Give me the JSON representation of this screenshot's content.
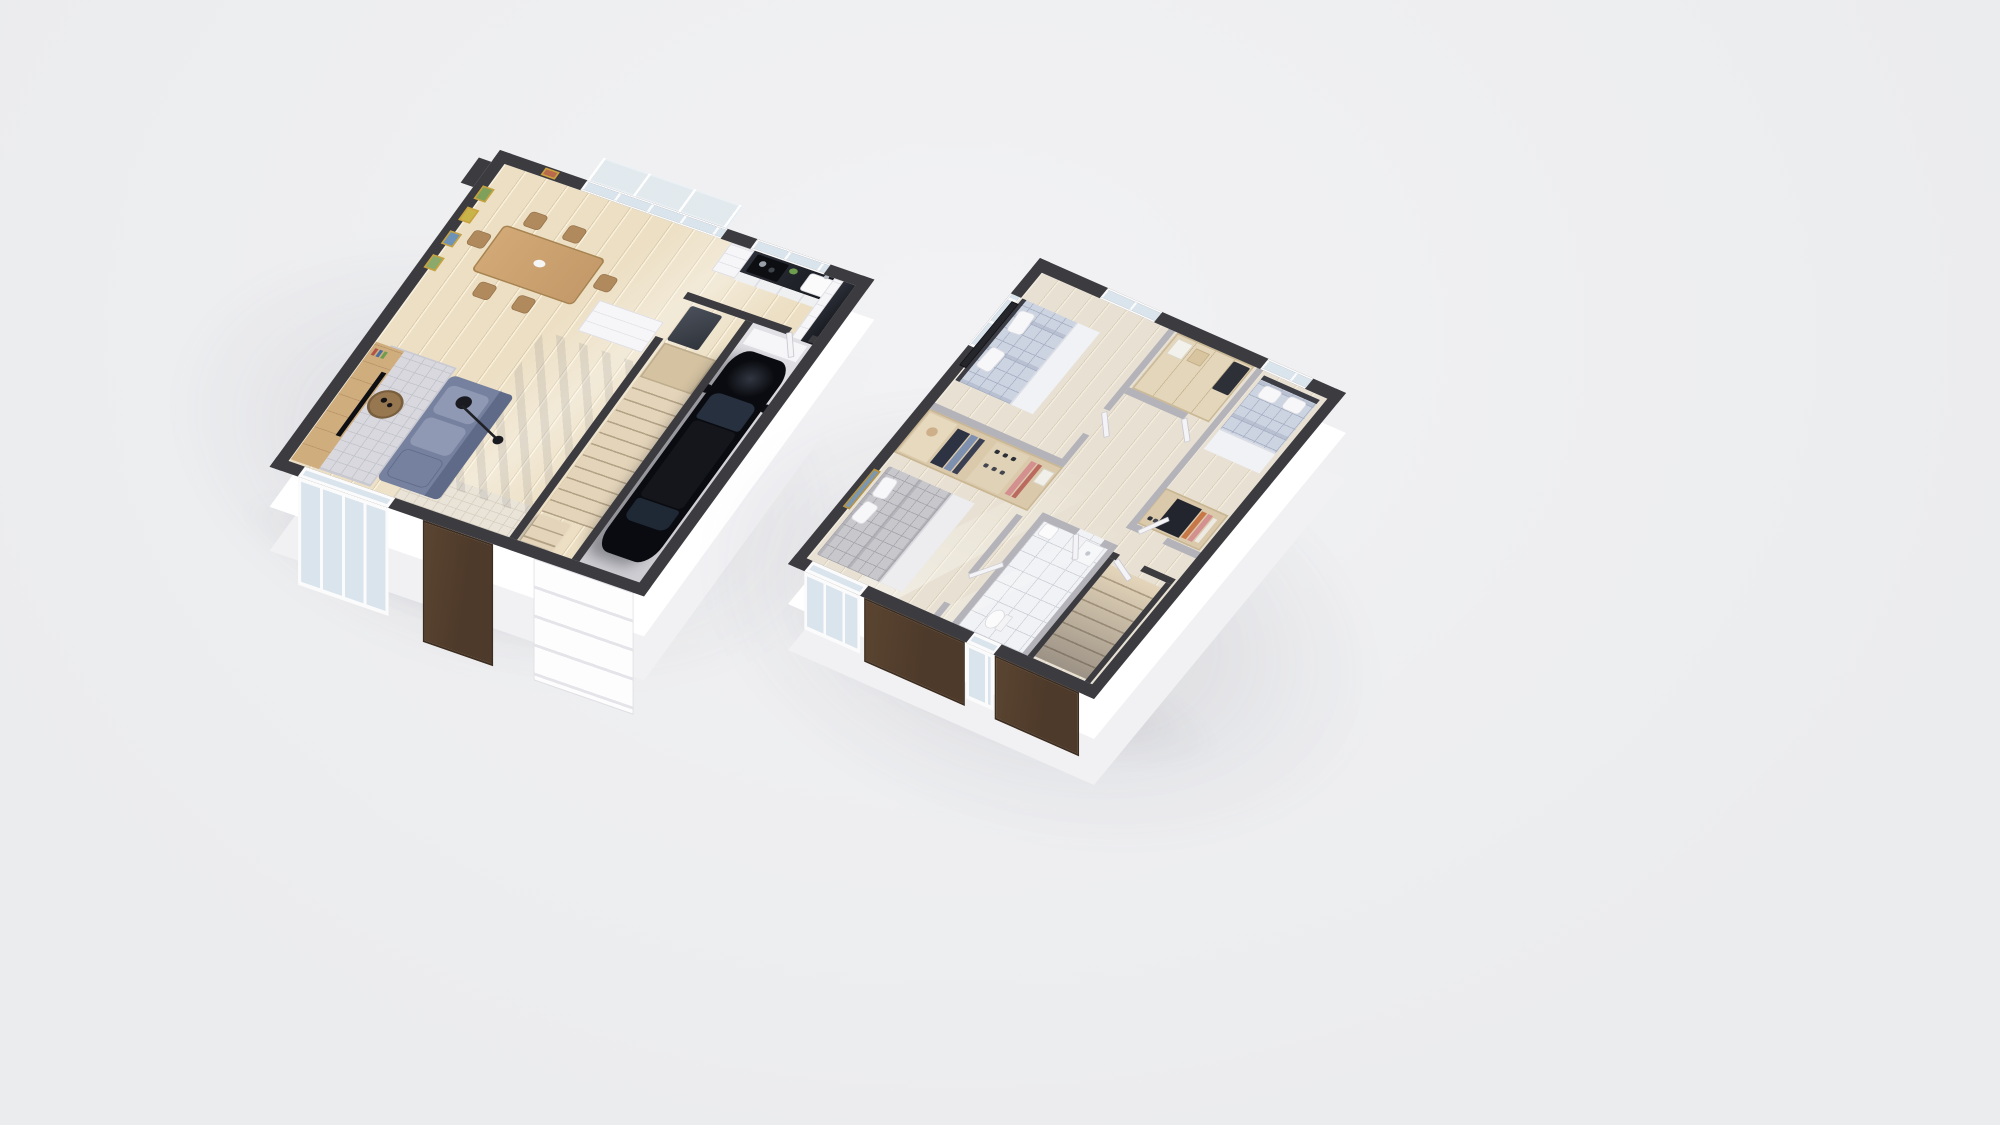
{
  "scene": {
    "name": "3d-floor-plan-render-two-story-house",
    "view": "isometric-birds-eye",
    "text_labels": [],
    "floor_count": 2,
    "floors": [
      {
        "name": "ground-floor",
        "position": "left",
        "rooms": [
          {
            "name": "living-dining-room",
            "floor_material": "light-wood-planks",
            "furniture": [
              "dining-table",
              "dining-chair x6",
              "table-bowl",
              "wall-art x4",
              "tv-media-wall",
              "tv-screen",
              "books",
              "sofa",
              "seat-cushion x2",
              "round-coffee-table",
              "arc-floor-lamp",
              "area-rug",
              "white-sideboard"
            ]
          },
          {
            "name": "kitchen",
            "floor_material": "light-wood-planks",
            "furniture": [
              "dark-stone-countertop",
              "sink",
              "faucet",
              "cooktop",
              "pots x2",
              "green-plate",
              "open-shelf-unit",
              "corner-cabinet-run",
              "kitchen-window",
              "balcony-glass-doors",
              "balcony-railing"
            ]
          },
          {
            "name": "hallway-stairwell",
            "floor_material": "light-wood-planks",
            "furniture": [
              "staircase-up",
              "stair-landing",
              "floating-lower-steps",
              "refrigerator",
              "entry-tile-floor",
              "front-door-brown"
            ]
          },
          {
            "name": "garage",
            "floor_material": "concrete",
            "furniture": [
              "black-car",
              "workbench",
              "sectional-garage-door",
              "service-door-to-kitchen"
            ]
          }
        ]
      },
      {
        "name": "upper-floor",
        "position": "right",
        "rooms": [
          {
            "name": "bedroom-1",
            "floor_material": "light-wood-planks",
            "furniture": [
              "double-bed-blue-plaid",
              "pillow x2",
              "headboard",
              "dark-panoramic-artwork",
              "window x2"
            ]
          },
          {
            "name": "walk-in-wardrobe",
            "furniture": [
              "open-wardrobe",
              "hat-shelf",
              "hanging-clothes-dark",
              "hanging-clothes-denim",
              "hanging-clothes-pink",
              "shoe-rack",
              "storage-box"
            ]
          },
          {
            "name": "bedroom-2",
            "floor_material": "light-wood-planks",
            "furniture": [
              "double-bed-gray-plaid",
              "pillow x2",
              "gold-framed-landscape-picture",
              "window"
            ]
          },
          {
            "name": "bedroom-3",
            "floor_material": "light-wood-planks",
            "furniture": [
              "bed-blue-plaid",
              "pillow x2",
              "wardrobe-with-clothes",
              "window"
            ]
          },
          {
            "name": "closet-storage-room",
            "furniture": [
              "wood-shelving",
              "dark-appliance",
              "storage-boxes"
            ]
          },
          {
            "name": "bathroom",
            "floor_material": "white-tile",
            "furniture": [
              "toilet",
              "washbasin",
              "shower-tray",
              "door"
            ]
          },
          {
            "name": "hallway",
            "floor_material": "light-wood-planks",
            "furniture": [
              "open-door x6",
              "staircase-down"
            ]
          }
        ]
      }
    ]
  },
  "colors": {
    "bg": "#ebecee",
    "bgHi": "#f2f2f4",
    "wallTop": "#3b3b40",
    "wallTopL": "#b3b3b9",
    "wallFace": "#ffffff",
    "slab": "#f1f1f4",
    "woodFloor": "#ecdfc4",
    "woodSeam": "#d9c6a3",
    "woodHi": "#f8f0dc",
    "hallFloor": "#e8e1d3",
    "hallSeam": "#d6cbb6",
    "garageA": "#e2e2e6",
    "garageB": "#cdcdd2",
    "tileBg": "#f1f2f5",
    "tileLine": "#cdd0d8",
    "entryTile": "#eae4d8",
    "entryLine": "#d7cfc0",
    "counter": "#24262d",
    "cabinet": "#f6f6f8",
    "tableWood": "#c59a6a",
    "chairWood": "#b08a5c",
    "tvWood": "#cfad7d",
    "screen": "#0e0f13",
    "sofa": "#76819f",
    "sofaHi": "#8f99b4",
    "sofaDk": "#5f6a88",
    "rug": "#d8d8de",
    "rugLine": "#c2c2cb",
    "lamp": "#1a1b20",
    "stairTread": "#e4d5ba",
    "stairGap": "#b3a286",
    "stairLand": "#d4c2a1",
    "car": "#0a0b10",
    "carGlass": "#26303e",
    "doorBrown": "#4e3a2a",
    "glass": "#d9e4ec",
    "frame": "#fbfbfc",
    "plaidBase": "#cdd4e1",
    "plaidLine": "#a6b0c4",
    "sheet": "#f1f2f5",
    "plaidGrayBase": "#c8c8cc",
    "plaidGrayLine": "#a4a4ab",
    "wardWood": "#dbc9ac",
    "wardWoodDk": "#c9b692",
    "clothesDark": "#2e3343",
    "denim": "#7e90b0",
    "pink": "#d4908f",
    "orange": "#c87848",
    "fixture": "#fbfbfc",
    "headboard": "#3c3d45",
    "artDark": "#25262c",
    "gold": "#b9933f"
  }
}
